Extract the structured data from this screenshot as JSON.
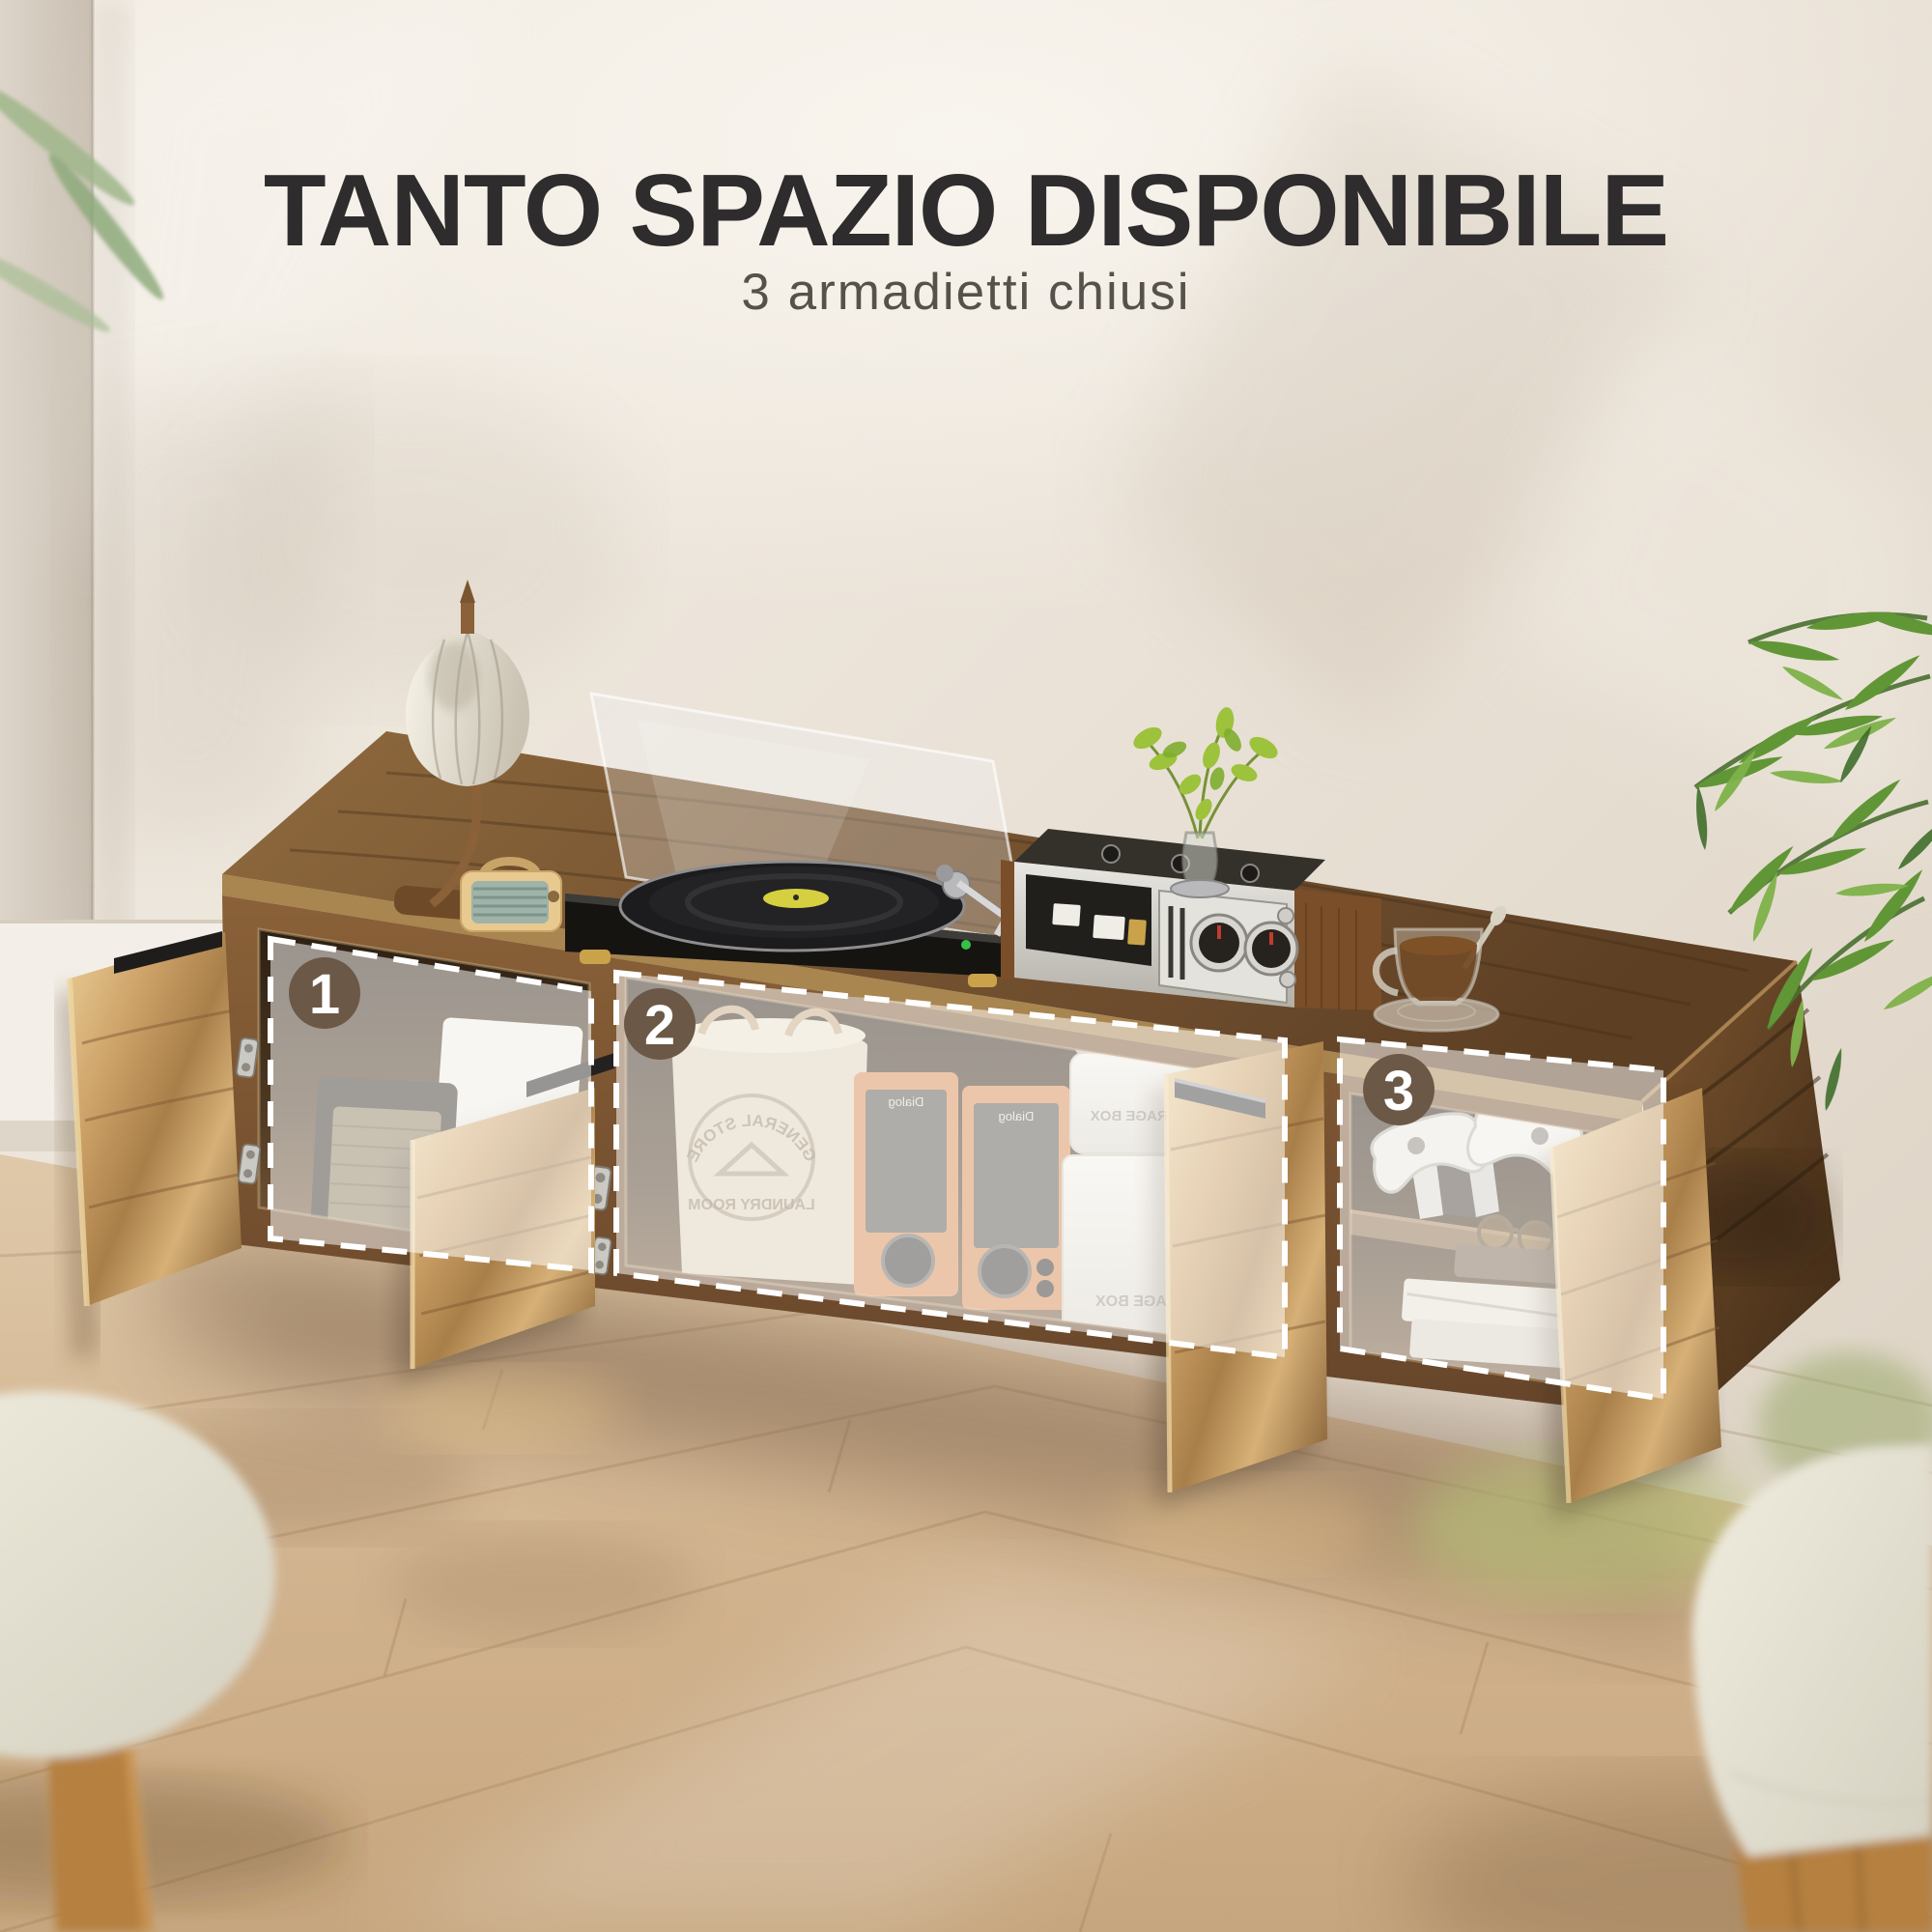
{
  "page": {
    "title": "TANTO SPAZIO DISPONIBILE",
    "subtitle": "3 armadietti chiusi"
  },
  "compartments": [
    {
      "number": "1"
    },
    {
      "number": "2"
    },
    {
      "number": "3"
    }
  ],
  "scene_text": {
    "speaker_brand": "Dialog",
    "storage_box_label": "STORAGE BOX",
    "basket_stamp_top": "GENERAL STORE",
    "basket_stamp_center": "LAUNDRY ROOM"
  },
  "colors": {
    "badge_background": "#6b5846",
    "badge_number": "#ffffff",
    "title_text": "#2e2c2d",
    "subtitle_text": "#56514b",
    "overlay_dash": "#ffffff",
    "cabinet_wood": "#8a6743",
    "wall": "#e9e1d6",
    "floor_wood": "#d3b злов"
  }
}
